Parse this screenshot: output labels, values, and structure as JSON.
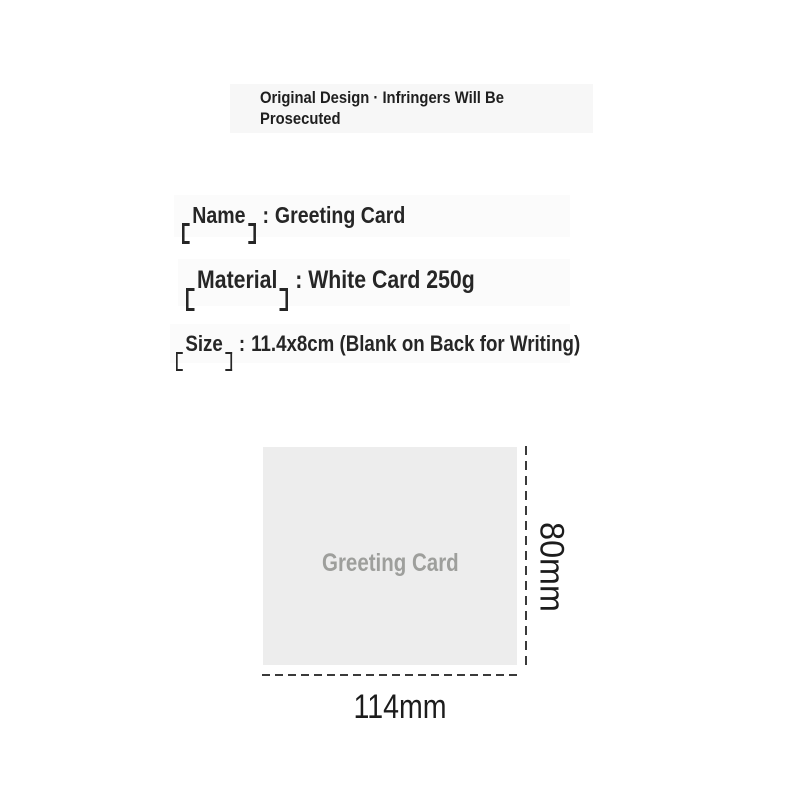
{
  "page": {
    "background_color": "#ffffff"
  },
  "colors": {
    "header_box_bg": "#f7f7f7",
    "row_strip_bg": "#fbfbfb",
    "heading_text": "#262626",
    "header_text": "#1f1f1f",
    "card_bg": "#ededed",
    "card_label_text": "#9e9f9c",
    "dimension_line": "#3a3a3a",
    "dimension_text": "#1c1c1c"
  },
  "header": {
    "line1": "Original Design · Infringers Will Be",
    "line2": "Prosecuted"
  },
  "specs": [
    {
      "bracket_open": "【",
      "label": "Name",
      "bracket_close": "】",
      "separator": ":",
      "value": "Greeting Card"
    },
    {
      "bracket_open": "【",
      "label": "Material",
      "bracket_close": "】",
      "separator": ":",
      "value": "White Card 250g"
    },
    {
      "bracket_open": "【",
      "label": "Size",
      "bracket_close": "】",
      "separator": ":",
      "value": "11.4x8cm (Blank on Back for Writing)"
    }
  ],
  "diagram": {
    "card_label": "Greeting Card",
    "height_label": "80mm",
    "width_label": "114mm"
  }
}
